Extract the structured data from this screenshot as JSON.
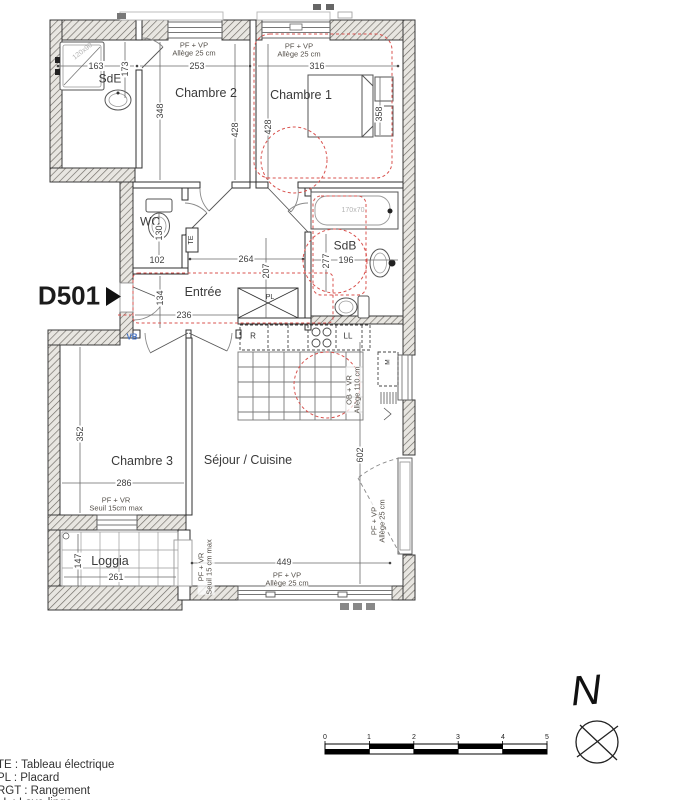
{
  "colors": {
    "accessibility_marking_red": "#d9534f",
    "vb_label_blue": "#4472c4",
    "wall_hatch_fill": "#e8e6e1",
    "line_dark": "#333333",
    "fixture_gray": "#555555",
    "faint_size_label": "#b3b3b3"
  },
  "texts": [
    {
      "name": "room-label-sde",
      "text": "SdE",
      "x": 110,
      "y": 79,
      "size": 12
    },
    {
      "name": "room-label-chambre2",
      "text": "Chambre 2",
      "x": 206,
      "y": 93,
      "size": 12.5
    },
    {
      "name": "room-label-chambre1",
      "text": "Chambre 1",
      "x": 301,
      "y": 95,
      "size": 12.5
    },
    {
      "name": "room-label-wc",
      "text": "WC",
      "x": 150,
      "y": 222,
      "size": 12
    },
    {
      "name": "room-label-entree",
      "text": "Entrée",
      "x": 203,
      "y": 292,
      "size": 12.5
    },
    {
      "name": "room-label-sdb",
      "text": "SdB",
      "x": 345,
      "y": 246,
      "size": 12
    },
    {
      "name": "room-label-chambre3",
      "text": "Chambre 3",
      "x": 142,
      "y": 461,
      "size": 12.5
    },
    {
      "name": "room-label-sejour-cuisine",
      "text": "Séjour / Cuisine",
      "x": 248,
      "y": 460,
      "size": 12.5
    },
    {
      "name": "room-label-loggia",
      "text": "Loggia",
      "x": 110,
      "y": 561,
      "size": 12.5
    },
    {
      "name": "unit-label-d501",
      "text": "D501",
      "x": 69,
      "y": 296,
      "size": 26,
      "weight": 600,
      "color": "#1c1c1c"
    },
    {
      "name": "dimension-label-163",
      "text": "163",
      "x": 96,
      "y": 66,
      "size": 9,
      "cls": "dim"
    },
    {
      "name": "dimension-label-173",
      "text": "173",
      "x": 125,
      "y": 69,
      "rot": -90,
      "size": 9,
      "cls": "dim"
    },
    {
      "name": "dimension-label-253",
      "text": "253",
      "x": 197,
      "y": 66,
      "size": 9,
      "cls": "dim"
    },
    {
      "name": "dimension-label-316",
      "text": "316",
      "x": 317,
      "y": 66,
      "size": 9,
      "cls": "dim"
    },
    {
      "name": "dimension-label-348",
      "text": "348",
      "x": 160,
      "y": 111,
      "rot": -90,
      "size": 9,
      "cls": "dim"
    },
    {
      "name": "dimension-label-428-left",
      "text": "428",
      "x": 235,
      "y": 130,
      "rot": -90,
      "size": 9,
      "cls": "dim"
    },
    {
      "name": "dimension-label-428-right",
      "text": "428",
      "x": 268,
      "y": 127,
      "rot": -90,
      "size": 9,
      "cls": "dim"
    },
    {
      "name": "dimension-label-358",
      "text": "358",
      "x": 379,
      "y": 114,
      "rot": -90,
      "size": 9,
      "cls": "dim"
    },
    {
      "name": "dimension-label-130",
      "text": "130",
      "x": 159,
      "y": 233,
      "rot": -90,
      "size": 9,
      "cls": "dim"
    },
    {
      "name": "dimension-label-102",
      "text": "102",
      "x": 157,
      "y": 260,
      "size": 9,
      "cls": "dim"
    },
    {
      "name": "dimension-label-264",
      "text": "264",
      "x": 246,
      "y": 259,
      "size": 9,
      "cls": "dim"
    },
    {
      "name": "dimension-label-207",
      "text": "207",
      "x": 266,
      "y": 271,
      "rot": -90,
      "size": 9,
      "cls": "dim"
    },
    {
      "name": "dimension-label-134",
      "text": "134",
      "x": 160,
      "y": 298,
      "rot": -90,
      "size": 9,
      "cls": "dim"
    },
    {
      "name": "dimension-label-236",
      "text": "236",
      "x": 184,
      "y": 315,
      "size": 9,
      "cls": "dim"
    },
    {
      "name": "dimension-label-277",
      "text": "277",
      "x": 326,
      "y": 261,
      "rot": -90,
      "size": 9,
      "cls": "dim"
    },
    {
      "name": "dimension-label-196",
      "text": "196",
      "x": 346,
      "y": 260,
      "size": 9,
      "cls": "dim"
    },
    {
      "name": "dimension-label-352",
      "text": "352",
      "x": 80,
      "y": 434,
      "rot": -90,
      "size": 9,
      "cls": "dim"
    },
    {
      "name": "dimension-label-286",
      "text": "286",
      "x": 124,
      "y": 483,
      "size": 9,
      "cls": "dim"
    },
    {
      "name": "dimension-label-602",
      "text": "602",
      "x": 360,
      "y": 455,
      "rot": -90,
      "size": 9,
      "cls": "dim"
    },
    {
      "name": "dimension-label-449",
      "text": "449",
      "x": 284,
      "y": 562,
      "size": 9,
      "cls": "dim"
    },
    {
      "name": "dimension-label-147",
      "text": "147",
      "x": 78,
      "y": 561,
      "rot": -90,
      "size": 9,
      "cls": "dim"
    },
    {
      "name": "dimension-label-261",
      "text": "261",
      "x": 116,
      "y": 577,
      "size": 9,
      "cls": "dim"
    },
    {
      "name": "window-annotation-top-left",
      "text": "PF + VP\nAllège 25 cm",
      "x": 194,
      "y": 50,
      "size": 7.5,
      "cls": "ann"
    },
    {
      "name": "window-annotation-top-right",
      "text": "PF + VP\nAllège 25 cm",
      "x": 299,
      "y": 51,
      "size": 7.5,
      "cls": "ann"
    },
    {
      "name": "window-annotation-kitchen",
      "text": "OB + VR\nAllège 110 cm",
      "x": 354,
      "y": 390,
      "rot": -90,
      "size": 7.5,
      "cls": "ann"
    },
    {
      "name": "window-annotation-chambre3",
      "text": "PF + VR\nSeuil 15cm max",
      "x": 116,
      "y": 505,
      "size": 7.5,
      "cls": "ann"
    },
    {
      "name": "window-annotation-loggia",
      "text": "PF + VR\nSeuil 15 cm max",
      "x": 206,
      "y": 567,
      "rot": -90,
      "size": 7.5,
      "cls": "ann"
    },
    {
      "name": "window-annotation-bottom",
      "text": "PF + VP\nAllège 25 cm",
      "x": 287,
      "y": 580,
      "size": 7.5,
      "cls": "ann"
    },
    {
      "name": "window-annotation-right",
      "text": "PF + VP\nAllège 25 cm",
      "x": 379,
      "y": 521,
      "rot": -90,
      "size": 7.5,
      "cls": "ann"
    },
    {
      "name": "fixture-size-shower",
      "text": "120x90",
      "x": 83,
      "y": 52,
      "rot": -38,
      "size": 7,
      "color": "#b3b3b3",
      "cls": "fixdim"
    },
    {
      "name": "fixture-size-bathtub",
      "text": "170x70",
      "x": 353,
      "y": 211,
      "size": 7,
      "color": "#b3b3b3",
      "cls": "fixdim"
    },
    {
      "name": "label-te",
      "text": "TE",
      "x": 192,
      "y": 240,
      "rot": -90,
      "size": 7,
      "color": "#333333"
    },
    {
      "name": "label-pl",
      "text": "PL",
      "x": 270,
      "y": 298,
      "size": 7,
      "color": "#333333"
    },
    {
      "name": "label-r",
      "text": "R",
      "x": 253,
      "y": 337,
      "size": 8,
      "color": "#333333"
    },
    {
      "name": "label-ll",
      "text": "LL",
      "x": 348,
      "y": 337,
      "size": 8,
      "color": "#333333"
    },
    {
      "name": "label-m",
      "text": "M",
      "x": 388,
      "y": 362,
      "rot": -90,
      "size": 6.5,
      "color": "#333333"
    },
    {
      "name": "label-vb",
      "text": "VB",
      "x": 132,
      "y": 338,
      "size": 8,
      "weight": 700,
      "color": "#4472c4"
    },
    {
      "name": "legend-line-te",
      "text": "TE : Tableau électrique",
      "x": -3,
      "y": 759,
      "size": 11.5,
      "cls": "legend",
      "anchor": "tl"
    },
    {
      "name": "legend-line-pl",
      "text": "PL : Placard",
      "x": -3,
      "y": 772,
      "size": 11.5,
      "cls": "legend",
      "anchor": "tl"
    },
    {
      "name": "legend-line-rgt",
      "text": "RGT : Rangement",
      "x": -3,
      "y": 785,
      "size": 11.5,
      "cls": "legend",
      "anchor": "tl"
    },
    {
      "name": "legend-line-clipped",
      "text": "LL : Lave-linge",
      "x": -3,
      "y": 797,
      "size": 11.5,
      "cls": "legend",
      "anchor": "tl"
    },
    {
      "name": "scale-tick-0",
      "text": "0",
      "x": 325,
      "y": 738,
      "size": 7,
      "color": "#222222"
    },
    {
      "name": "scale-tick-1",
      "text": "1",
      "x": 369,
      "y": 738,
      "size": 7,
      "color": "#222222"
    },
    {
      "name": "scale-tick-2",
      "text": "2",
      "x": 414,
      "y": 738,
      "size": 7,
      "color": "#222222"
    },
    {
      "name": "scale-tick-3",
      "text": "3",
      "x": 458,
      "y": 738,
      "size": 7,
      "color": "#222222"
    },
    {
      "name": "scale-tick-4",
      "text": "4",
      "x": 503,
      "y": 738,
      "size": 7,
      "color": "#222222"
    },
    {
      "name": "scale-tick-5",
      "text": "5",
      "x": 547,
      "y": 738,
      "size": 7,
      "color": "#222222"
    },
    {
      "name": "north-letter",
      "text": "N",
      "x": 586,
      "y": 690,
      "rot": -4,
      "size": 42,
      "cls": "north"
    }
  ]
}
